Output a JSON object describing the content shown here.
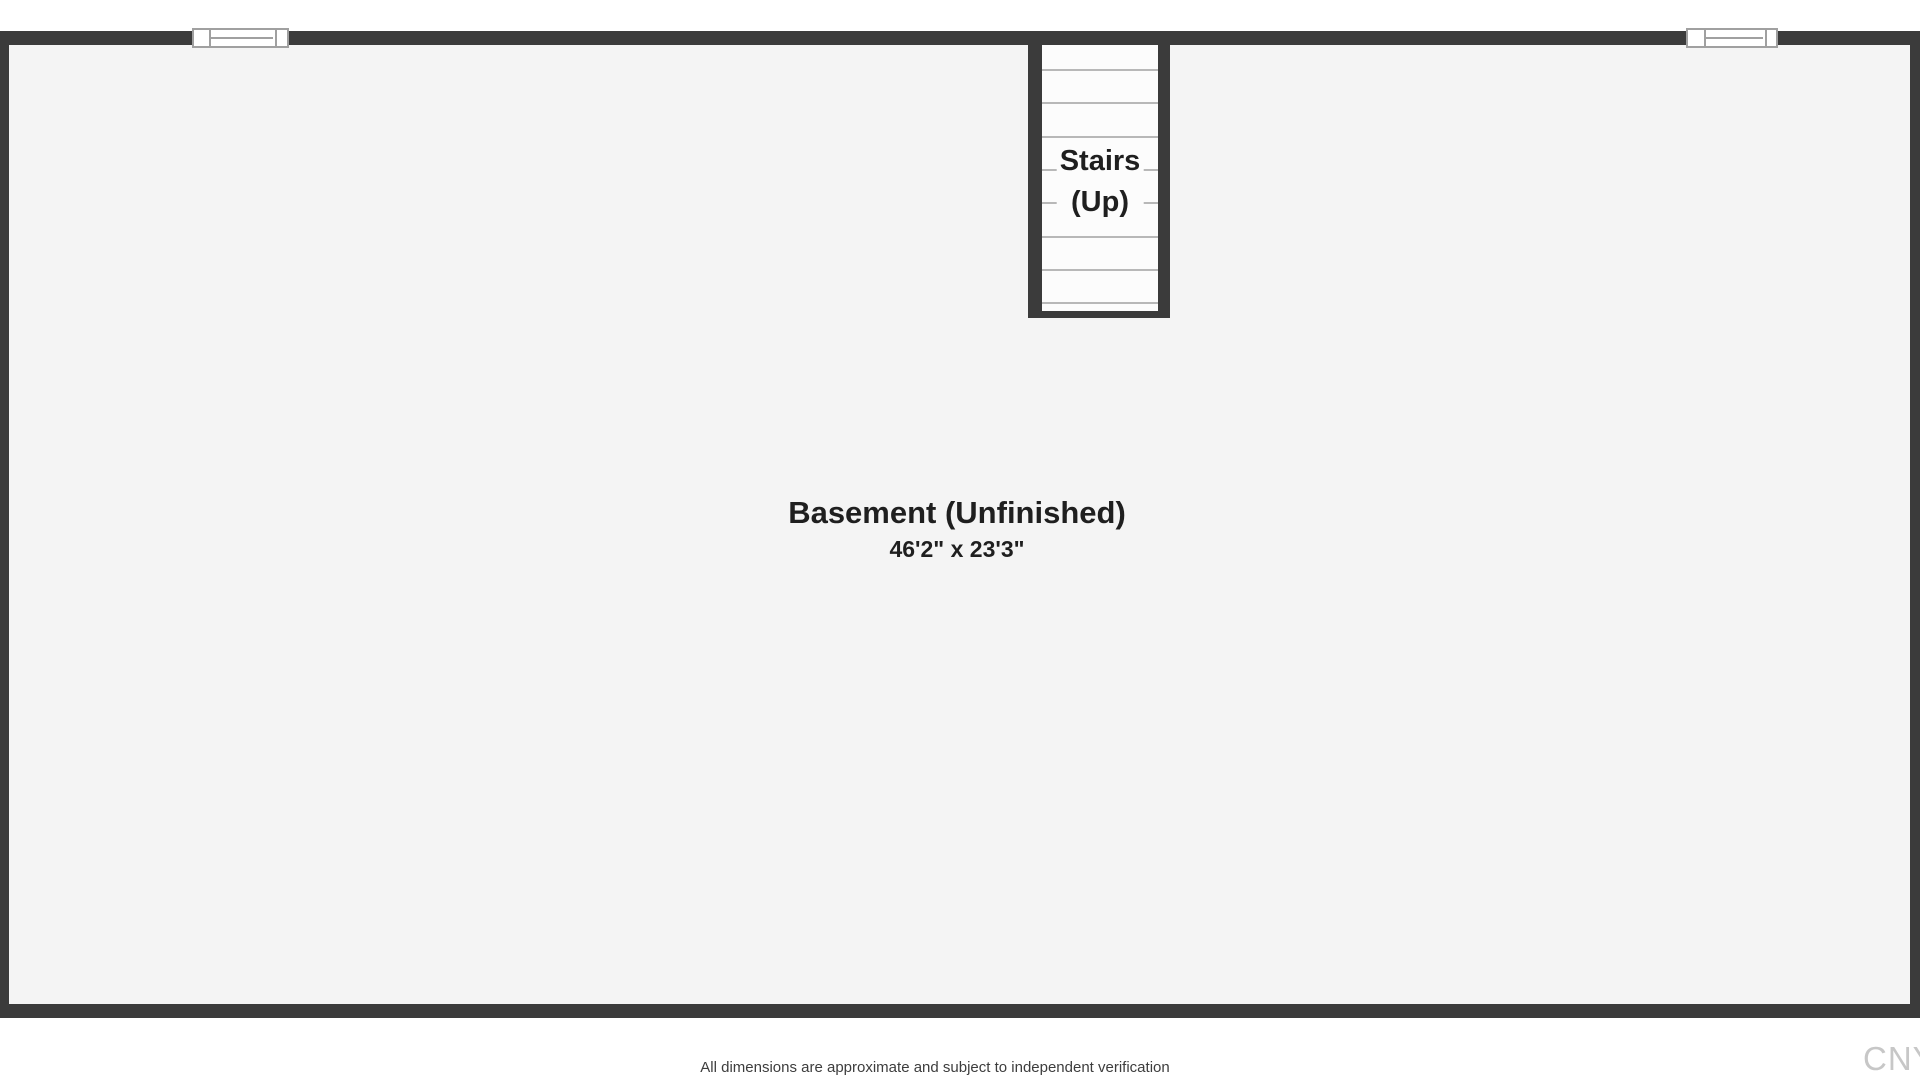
{
  "plan": {
    "room": {
      "label": "Basement (Unfinished)",
      "dimensions": "46'2\" x 23'3\""
    },
    "stairs": {
      "label_line1": "Stairs",
      "label_line2": "(Up)",
      "tread_count": 8,
      "tread_start_y": 24,
      "tread_spacing": 33.3
    },
    "window_count": 2
  },
  "footer": {
    "disclaimer": "All dimensions are approximate and subject to independent verification",
    "watermark": "CNY"
  },
  "colors": {
    "wall": "#3b3b3b",
    "room_fill": "#f4f4f4",
    "stair_fill": "#fcfcfc",
    "tread_line": "#b8b8b8",
    "window_frame": "#a0a0a0",
    "text": "#1f1f1f",
    "watermark": "#c7c7c7"
  }
}
